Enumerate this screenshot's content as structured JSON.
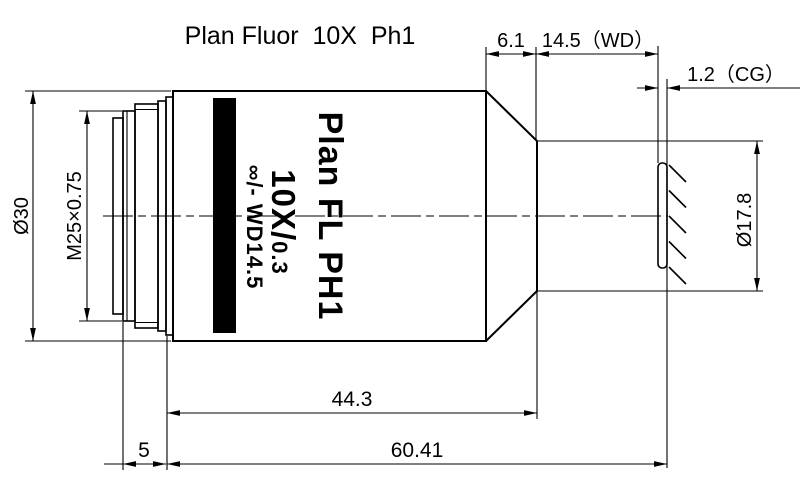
{
  "drawing": {
    "title": "Plan Fluor  10X  Ph1",
    "objective_marking": {
      "name": "Plan FL PH1",
      "magnification": "10X/",
      "numerical_aperture": "0.3",
      "tube_wd": "∞/- WD14.5"
    },
    "dims": {
      "cone_length": "6.1",
      "working_distance": "14.5（WD）",
      "cover_glass": "1.2（CG）",
      "body_diameter": "Ø30",
      "mount_thread": "M25×0.75",
      "front_diameter": "Ø17.8",
      "shoulder_to_front": "44.3",
      "thread_length": "5",
      "parfocal_distance": "60.41"
    },
    "colors": {
      "line": "#000000",
      "band": "#000000",
      "background": "#ffffff"
    }
  }
}
